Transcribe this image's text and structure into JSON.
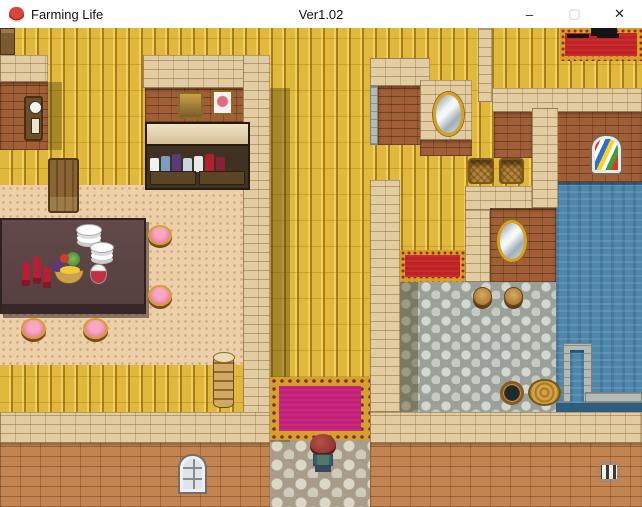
{
  "window": {
    "title": "Farming Life",
    "version_label": "Ver1.02",
    "icon": "character-face-app-icon",
    "controls": {
      "minimize": "–",
      "maximize": "▢",
      "close": "✕",
      "maximize_disabled": true
    }
  },
  "colors": {
    "plank_gold": "#e0b93c",
    "plank_light": "#f0cf5e",
    "plank_dark": "#a67c1e",
    "carpet_peach": "#ecd0aa",
    "wall_top_tan": "#e2cda3",
    "wall_face_brown": "#a05f36",
    "wall_ext": "#c28551",
    "cobble_base": "#9aa198",
    "cobble_stone": "#d3d7d1",
    "flag_base": "#a79d8a",
    "flag_stone": "#dcd8c8",
    "water_blue": "#4e86ac",
    "water_deep": "#2f5d7e",
    "rug_pink": "#c32079",
    "rug_red": "#c02124",
    "gold_trim": "#d4a22b",
    "table_brown": "#5a4240",
    "stool_pink": "#ee8fad",
    "ui_white": "#ffffff",
    "ui_text": "#111111"
  },
  "scene": {
    "description": "Top-down RPG interior: dining room with table and pink stools, kitchen cabinet with dishes, corridor, basket room with mirrors, cobblestone pool room with blue pool, exterior wall with entry path and player character",
    "objects": [
      "corner-shelf",
      "grandfather-clock",
      "portrait-painting",
      "flower-painting",
      "kitchen-cabinet",
      "wooden-chair",
      "dining-table",
      "plate-stack",
      "wine-bottles",
      "fruit-bowl",
      "wine-decanter",
      "pink-stool",
      "pink-stool",
      "pink-stool",
      "pink-stool",
      "log-stack",
      "red-carpet",
      "black-table",
      "oval-mirror",
      "oval-mirror",
      "wicker-basket",
      "wicker-basket",
      "stained-glass-window",
      "swimming-pool",
      "pool-steps",
      "red-rug",
      "wooden-stool",
      "wooden-stool",
      "water-bucket",
      "wooden-basin",
      "pink-rug",
      "stone-path",
      "player-character",
      "arched-window",
      "barred-vent"
    ]
  }
}
